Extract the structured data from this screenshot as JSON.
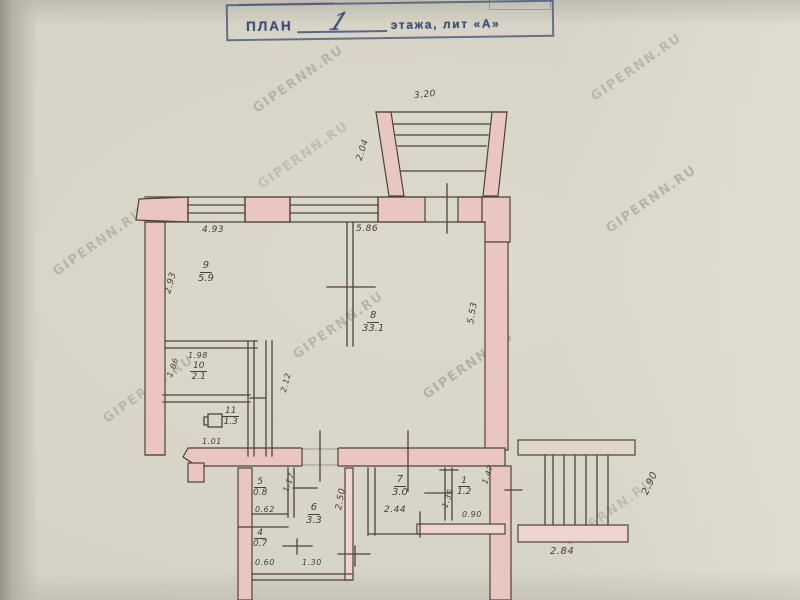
{
  "title": {
    "prefix": "ПЛАН",
    "floor": "1",
    "suffix": "этажа, лит «А»"
  },
  "watermark": "GIPERNN.RU",
  "rooms": {
    "r9": {
      "num": "9",
      "area": "5.9"
    },
    "r10": {
      "num": "10",
      "area": "2.1"
    },
    "r11": {
      "num": "11",
      "area": "1.3"
    },
    "r8": {
      "num": "8",
      "area": "33.1"
    },
    "r5": {
      "num": "5",
      "area": "0.8"
    },
    "r6": {
      "num": "6",
      "area": "3.3"
    },
    "r4": {
      "num": "4",
      "area": "0.7"
    },
    "r7": {
      "num": "7",
      "area": "3.0"
    },
    "r1": {
      "num": "1",
      "area": "1.2"
    }
  },
  "dims": {
    "balcony_width": "3.20",
    "balcony_depth": "2.04",
    "win_left": "4.93",
    "win_right": "5.86",
    "room9_height": "2.93",
    "room8_height": "5.53",
    "room10_width": "1.98",
    "room10_height": "1.06",
    "partition_height": "2.12",
    "room11_width": "1.01",
    "room5_width": "0.62",
    "room5_height": "1.17",
    "room6_height": "2.50",
    "room4_width": "0.60",
    "hall_width": "1.30",
    "room7_width": "2.44",
    "room1_width": "0.90",
    "room1_left": "1.35",
    "room1_right": "1.47",
    "stairs_width": "2.84",
    "stairs_height": "2.90"
  }
}
